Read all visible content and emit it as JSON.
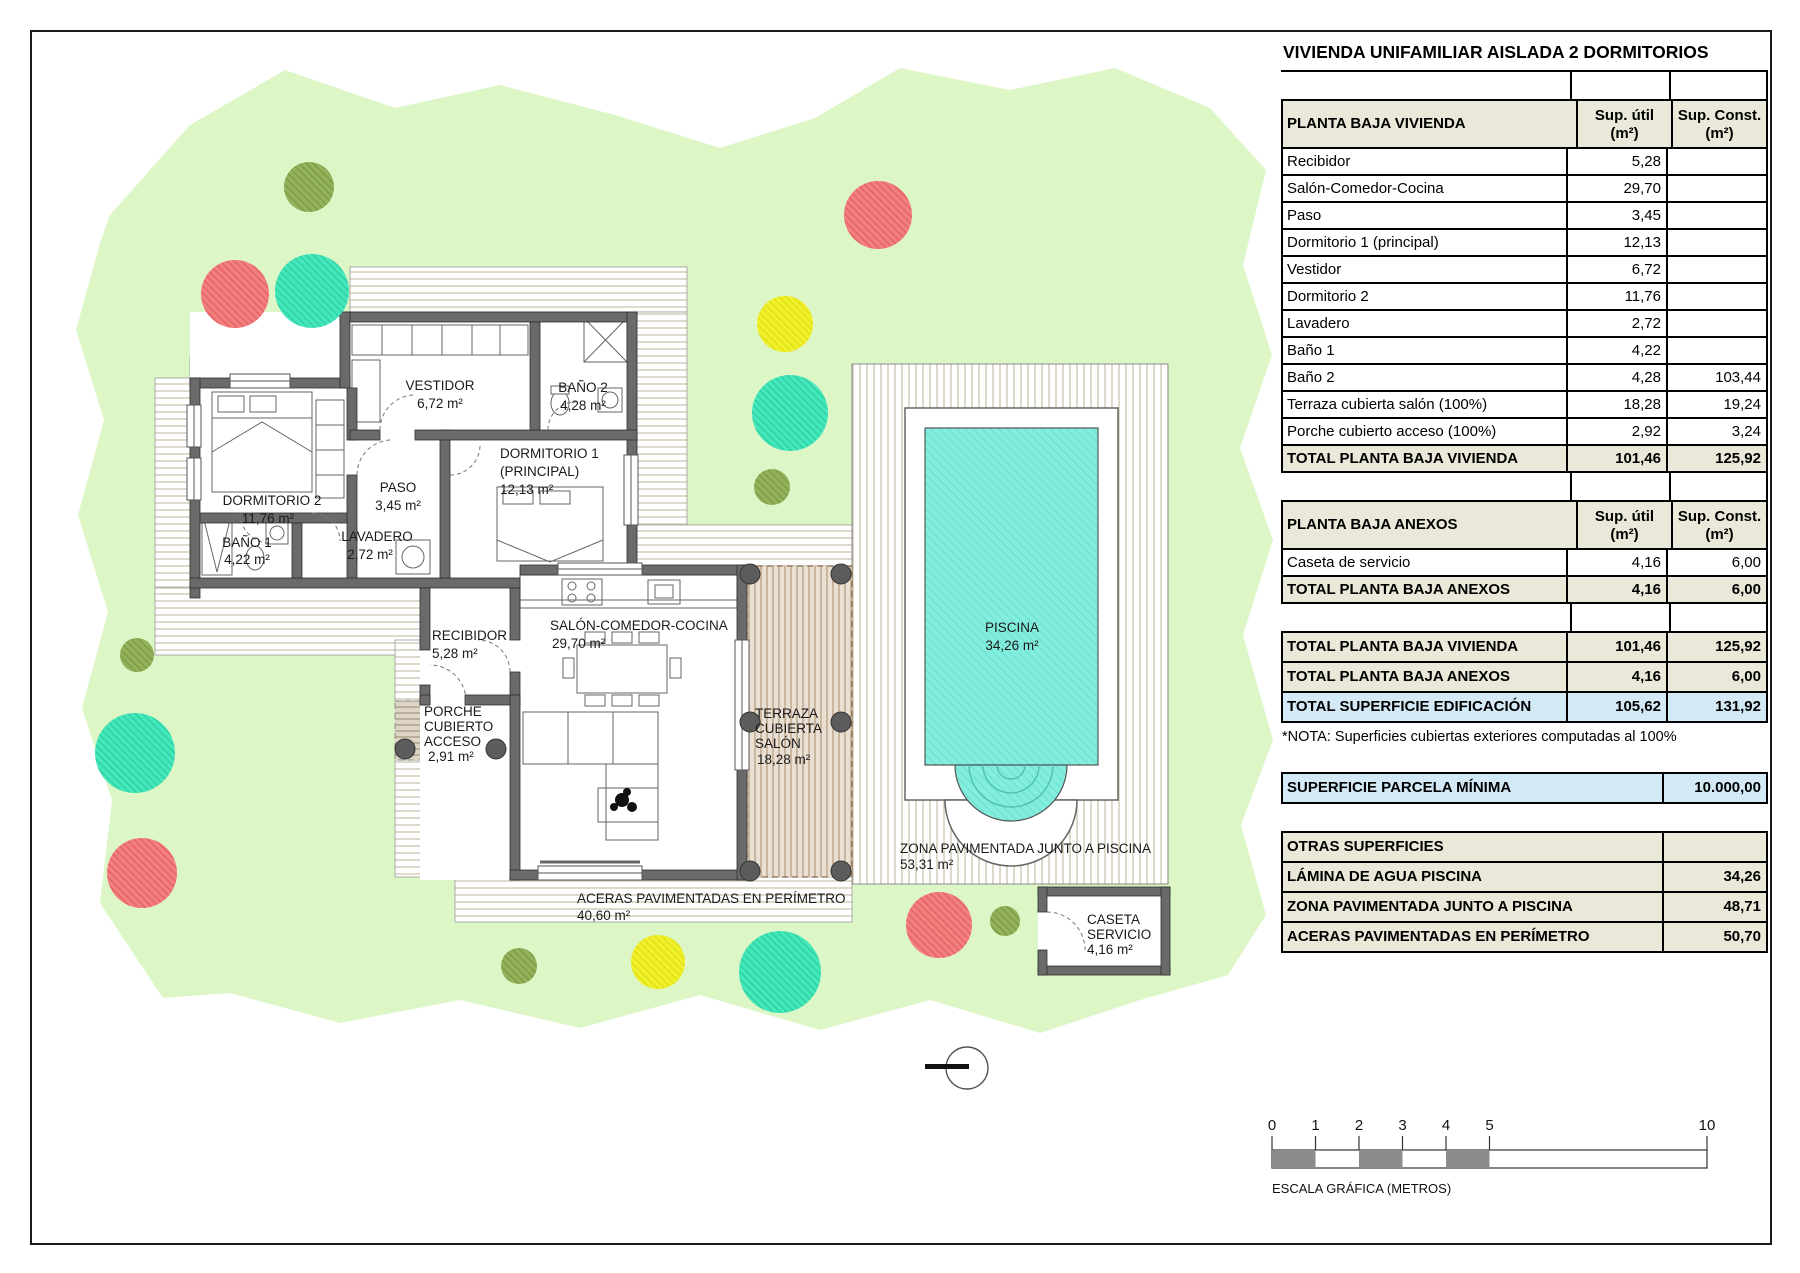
{
  "title": "VIVIENDA UNIFAMILIAR AISLADA 2 DORMITORIOS",
  "colors": {
    "grass": "#ddf6c6",
    "deck_stripe": "#c9c0a8",
    "terrace_stripe": "#b39a7c",
    "pool_water": "#84eede",
    "wall_gray": "#6a6a6a",
    "table_header_beige": "#eae8d8",
    "table_highlight_blue": "#d3eaf6",
    "tree_teal": "#44e8bd",
    "tree_red": "#f28080",
    "tree_yellow": "#f0f02c",
    "tree_olive": "#94b15c",
    "scalebar_gray": "#8c8c8c"
  },
  "tables": {
    "colhead": {
      "util1": "Sup. útil",
      "util2": "(m²)",
      "const1": "Sup. Const.",
      "const2": "(m²)"
    },
    "vivienda": {
      "header": "PLANTA BAJA VIVIENDA",
      "rows": [
        {
          "label": "Recibidor",
          "util": "5,28",
          "const": ""
        },
        {
          "label": "Salón-Comedor-Cocina",
          "util": "29,70",
          "const": ""
        },
        {
          "label": "Paso",
          "util": "3,45",
          "const": ""
        },
        {
          "label": "Dormitorio 1 (principal)",
          "util": "12,13",
          "const": ""
        },
        {
          "label": "Vestidor",
          "util": "6,72",
          "const": ""
        },
        {
          "label": "Dormitorio 2",
          "util": "11,76",
          "const": ""
        },
        {
          "label": "Lavadero",
          "util": "2,72",
          "const": ""
        },
        {
          "label": "Baño 1",
          "util": "4,22",
          "const": ""
        },
        {
          "label": "Baño 2",
          "util": "4,28",
          "const": "103,44"
        },
        {
          "label": "Terraza cubierta salón (100%)",
          "util": "18,28",
          "const": "19,24"
        },
        {
          "label": "Porche cubierto acceso (100%)",
          "util": "2,92",
          "const": "3,24"
        }
      ],
      "total": {
        "label": "TOTAL PLANTA BAJA VIVIENDA",
        "util": "101,46",
        "const": "125,92"
      }
    },
    "anexos": {
      "header": "PLANTA BAJA ANEXOS",
      "rows": [
        {
          "label": "Caseta de servicio",
          "util": "4,16",
          "const": "6,00"
        }
      ],
      "total": {
        "label": "TOTAL PLANTA BAJA ANEXOS",
        "util": "4,16",
        "const": "6,00"
      }
    },
    "totales": [
      {
        "label": "TOTAL PLANTA BAJA VIVIENDA",
        "util": "101,46",
        "const": "125,92"
      },
      {
        "label": "TOTAL PLANTA BAJA ANEXOS",
        "util": "4,16",
        "const": "6,00"
      },
      {
        "label": "TOTAL SUPERFICIE EDIFICACIÓN",
        "util": "105,62",
        "const": "131,92"
      }
    ],
    "nota": "*NOTA: Superficies cubiertas exteriores computadas al 100%",
    "parcela": {
      "label": "SUPERFICIE PARCELA MÍNIMA",
      "value": "10.000,00"
    },
    "otras": {
      "header": "OTRAS SUPERFICIES",
      "rows": [
        {
          "label": "LÁMINA DE AGUA PISCINA",
          "value": "34,26"
        },
        {
          "label": "ZONA PAVIMENTADA JUNTO A PISCINA",
          "value": "48,71"
        },
        {
          "label": "ACERAS PAVIMENTADAS EN PERÍMETRO",
          "value": "50,70"
        }
      ]
    }
  },
  "plan": {
    "labels": [
      "VESTIDOR",
      "6,72 m²",
      "BAÑO 2",
      "4,28 m²",
      "DORMITORIO 2",
      "11,76 m²",
      "PASO",
      "3,45 m²",
      "DORMITORIO 1",
      "(PRINCIPAL)",
      "12,13 m²",
      "BAÑO 1",
      "4,22 m²",
      "LAVADERO",
      "2,72 m²",
      "RECIBIDOR",
      "5,28 m²",
      "SALÓN-COMEDOR-COCINA",
      "29,70 m²",
      "PORCHE",
      "CUBIERTO",
      "ACCESO",
      "2,91 m²",
      "TERRAZA",
      "CUBIERTA",
      "SALÓN",
      "18,28 m²",
      "ACERAS PAVIMENTADAS EN PERÍMETRO",
      "40,60 m²",
      "PISCINA",
      "34,26 m²",
      "ZONA PAVIMENTADA JUNTO A PISCINA",
      "53,31 m²",
      "CASETA",
      "SERVICIO",
      "4,16 m²"
    ],
    "scale": {
      "ticks": [
        "0",
        "1",
        "2",
        "3",
        "4",
        "5",
        "10"
      ],
      "caption": "ESCALA GRÁFICA (METROS)"
    }
  }
}
